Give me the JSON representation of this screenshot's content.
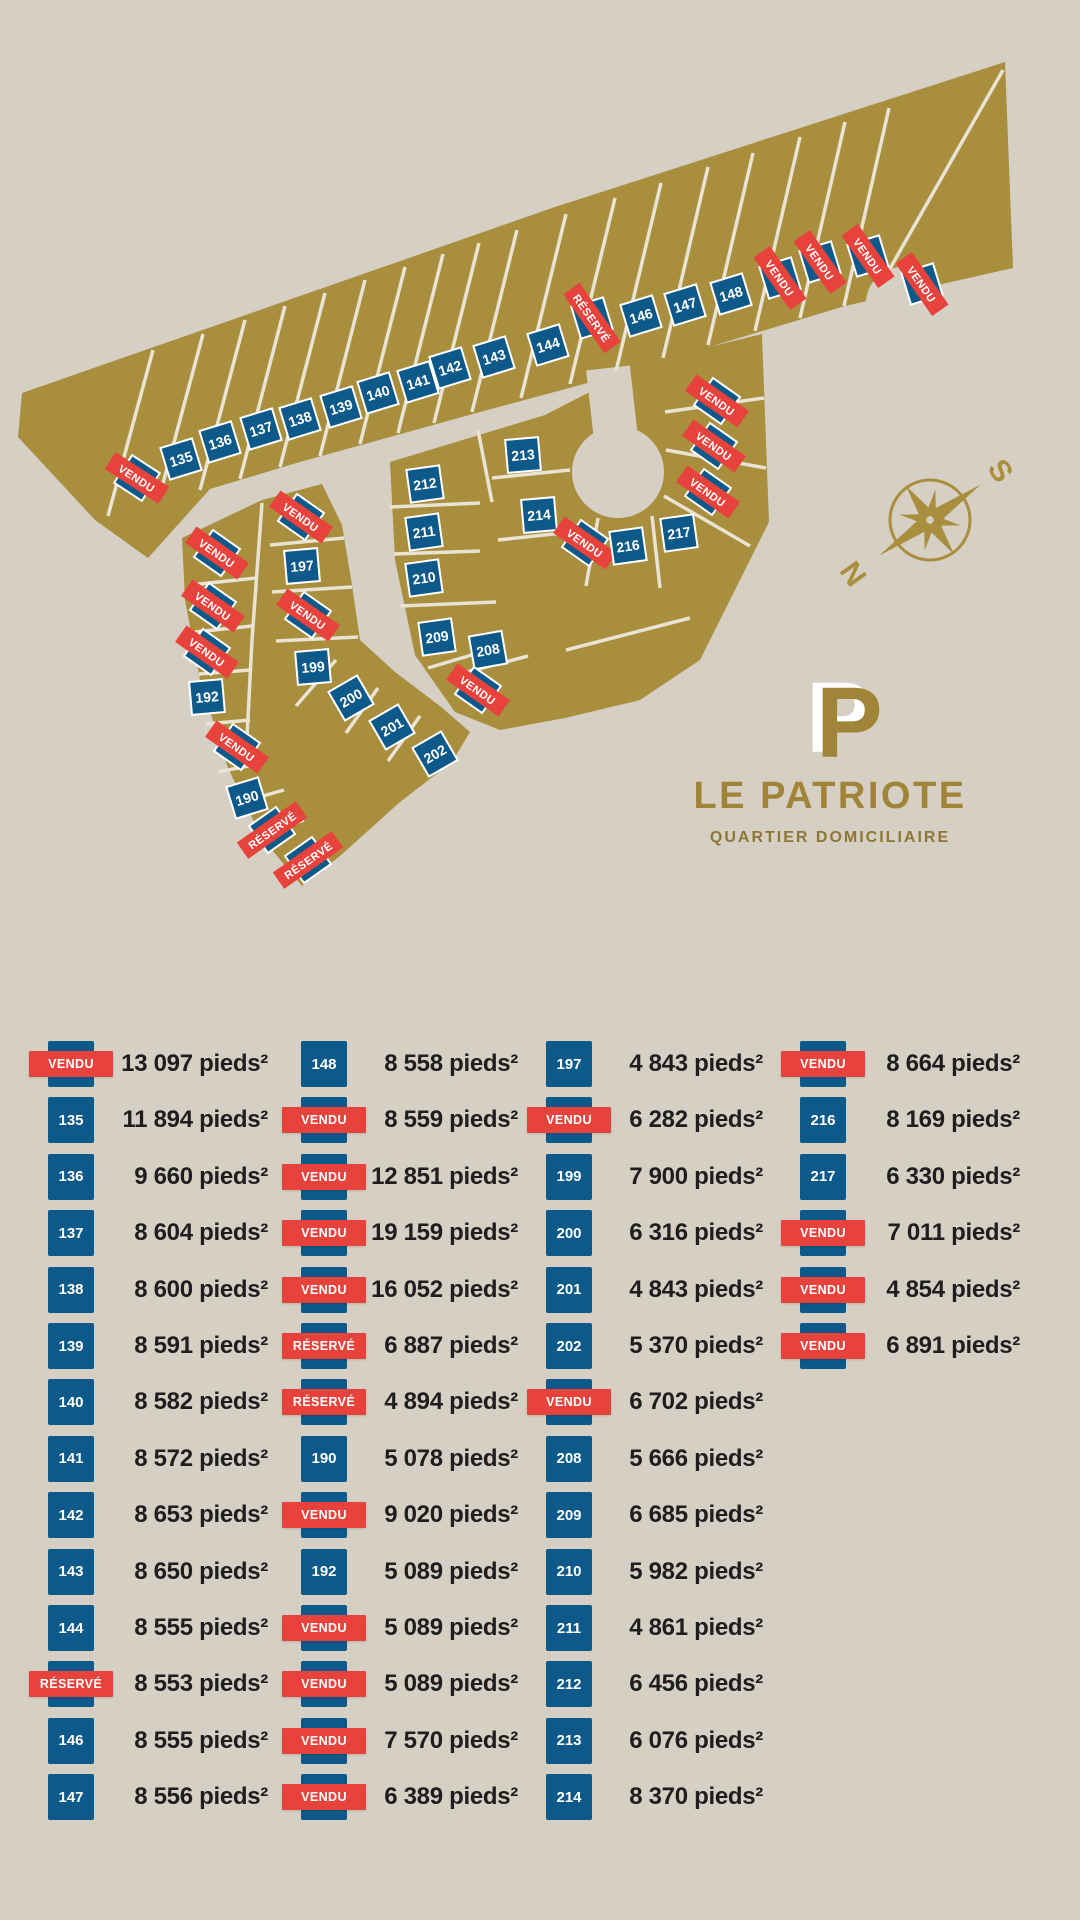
{
  "colors": {
    "background": "#d6d0c4",
    "gold": "#a98e3e",
    "blue": "#0d5a8a",
    "red": "#e8423d",
    "road": "#e9e3d3",
    "text": "#1e1e1e",
    "logo_gold": "#a08539"
  },
  "map": {
    "compass": {
      "north": "N",
      "south": "S"
    },
    "logo": {
      "monogram": "P",
      "title": "LE PATRIOTE",
      "subtitle": "QUARTIER DOMICILIAIRE"
    },
    "lots": [
      {
        "label": "VENDU",
        "type": "vendu",
        "x": 137,
        "y": 478,
        "rot": 33
      },
      {
        "label": "135",
        "type": "num",
        "x": 181,
        "y": 459,
        "rot": -17
      },
      {
        "label": "136",
        "type": "num",
        "x": 220,
        "y": 442,
        "rot": -17
      },
      {
        "label": "137",
        "type": "num",
        "x": 261,
        "y": 429,
        "rot": -17
      },
      {
        "label": "138",
        "type": "num",
        "x": 300,
        "y": 419,
        "rot": -17
      },
      {
        "label": "139",
        "type": "num",
        "x": 341,
        "y": 407,
        "rot": -17
      },
      {
        "label": "140",
        "type": "num",
        "x": 378,
        "y": 393,
        "rot": -17
      },
      {
        "label": "141",
        "type": "num",
        "x": 418,
        "y": 382,
        "rot": -17
      },
      {
        "label": "142",
        "type": "num",
        "x": 450,
        "y": 368,
        "rot": -17
      },
      {
        "label": "143",
        "type": "num",
        "x": 494,
        "y": 357,
        "rot": -17
      },
      {
        "label": "144",
        "type": "num",
        "x": 548,
        "y": 345,
        "rot": -17
      },
      {
        "label": "RÉSERVÉ",
        "type": "reserve",
        "x": 592,
        "y": 318,
        "rot": 55
      },
      {
        "label": "146",
        "type": "num",
        "x": 641,
        "y": 316,
        "rot": -17
      },
      {
        "label": "147",
        "type": "num",
        "x": 685,
        "y": 305,
        "rot": -17
      },
      {
        "label": "148",
        "type": "num",
        "x": 731,
        "y": 294,
        "rot": -17
      },
      {
        "label": "VENDU",
        "type": "vendu",
        "x": 780,
        "y": 278,
        "rot": 55
      },
      {
        "label": "VENDU",
        "type": "vendu",
        "x": 820,
        "y": 262,
        "rot": 55
      },
      {
        "label": "VENDU",
        "type": "vendu",
        "x": 868,
        "y": 256,
        "rot": 55
      },
      {
        "label": "VENDU",
        "type": "vendu",
        "x": 922,
        "y": 284,
        "rot": 55
      },
      {
        "label": "VENDU",
        "type": "vendu",
        "x": 217,
        "y": 553,
        "rot": 35
      },
      {
        "label": "VENDU",
        "type": "vendu",
        "x": 213,
        "y": 606,
        "rot": 35
      },
      {
        "label": "VENDU",
        "type": "vendu",
        "x": 207,
        "y": 652,
        "rot": 35
      },
      {
        "label": "192",
        "type": "num",
        "x": 207,
        "y": 697,
        "rot": -5
      },
      {
        "label": "VENDU",
        "type": "vendu",
        "x": 237,
        "y": 747,
        "rot": 35
      },
      {
        "label": "190",
        "type": "num",
        "x": 247,
        "y": 798,
        "rot": -50
      },
      {
        "label": "RÉSERVÉ",
        "type": "reserve",
        "x": 272,
        "y": 830,
        "rot": -35
      },
      {
        "label": "RÉSERVÉ",
        "type": "reserve",
        "x": 308,
        "y": 860,
        "rot": -35
      },
      {
        "label": "VENDU",
        "type": "vendu",
        "x": 301,
        "y": 517,
        "rot": 35
      },
      {
        "label": "197",
        "type": "num",
        "x": 302,
        "y": 566,
        "rot": -5
      },
      {
        "label": "VENDU",
        "type": "vendu",
        "x": 308,
        "y": 615,
        "rot": 35
      },
      {
        "label": "199",
        "type": "num",
        "x": 313,
        "y": 667,
        "rot": -5
      },
      {
        "label": "200",
        "type": "num",
        "x": 351,
        "y": 698,
        "rot": -30
      },
      {
        "label": "201",
        "type": "num",
        "x": 392,
        "y": 727,
        "rot": -30
      },
      {
        "label": "202",
        "type": "num",
        "x": 435,
        "y": 754,
        "rot": -30
      },
      {
        "label": "212",
        "type": "num",
        "x": 425,
        "y": 484,
        "rot": -8
      },
      {
        "label": "211",
        "type": "num",
        "x": 424,
        "y": 532,
        "rot": -8
      },
      {
        "label": "210",
        "type": "num",
        "x": 424,
        "y": 578,
        "rot": -8
      },
      {
        "label": "209",
        "type": "num",
        "x": 437,
        "y": 637,
        "rot": -8
      },
      {
        "label": "213",
        "type": "num",
        "x": 523,
        "y": 455,
        "rot": -5
      },
      {
        "label": "214",
        "type": "num",
        "x": 539,
        "y": 515,
        "rot": -5
      },
      {
        "label": "208",
        "type": "num",
        "x": 488,
        "y": 650,
        "rot": -10
      },
      {
        "label": "VENDU",
        "type": "vendu",
        "x": 478,
        "y": 690,
        "rot": 35
      },
      {
        "label": "VENDU",
        "type": "vendu",
        "x": 585,
        "y": 543,
        "rot": 35
      },
      {
        "label": "216",
        "type": "num",
        "x": 628,
        "y": 546,
        "rot": -8
      },
      {
        "label": "217",
        "type": "num",
        "x": 679,
        "y": 533,
        "rot": -8
      },
      {
        "label": "VENDU",
        "type": "vendu",
        "x": 708,
        "y": 492,
        "rot": 35
      },
      {
        "label": "VENDU",
        "type": "vendu",
        "x": 714,
        "y": 446,
        "rot": 35
      },
      {
        "label": "VENDU",
        "type": "vendu",
        "x": 717,
        "y": 401,
        "rot": 35
      }
    ]
  },
  "legend": {
    "columns": [
      {
        "rows": [
          {
            "tag": "VENDU",
            "type": "vendu",
            "size": "13 097 pieds²"
          },
          {
            "tag": "135",
            "type": "num",
            "size": "11 894 pieds²"
          },
          {
            "tag": "136",
            "type": "num",
            "size": "9 660 pieds²"
          },
          {
            "tag": "137",
            "type": "num",
            "size": "8 604 pieds²"
          },
          {
            "tag": "138",
            "type": "num",
            "size": "8 600 pieds²"
          },
          {
            "tag": "139",
            "type": "num",
            "size": "8 591 pieds²"
          },
          {
            "tag": "140",
            "type": "num",
            "size": "8 582 pieds²"
          },
          {
            "tag": "141",
            "type": "num",
            "size": "8 572 pieds²"
          },
          {
            "tag": "142",
            "type": "num",
            "size": "8 653 pieds²"
          },
          {
            "tag": "143",
            "type": "num",
            "size": "8 650 pieds²"
          },
          {
            "tag": "144",
            "type": "num",
            "size": "8 555 pieds²"
          },
          {
            "tag": "RÉSERVÉ",
            "type": "reserve",
            "size": "8 553 pieds²"
          },
          {
            "tag": "146",
            "type": "num",
            "size": "8 555 pieds²"
          },
          {
            "tag": "147",
            "type": "num",
            "size": "8 556 pieds²"
          }
        ]
      },
      {
        "rows": [
          {
            "tag": "148",
            "type": "num",
            "size": "8 558 pieds²"
          },
          {
            "tag": "VENDU",
            "type": "vendu",
            "size": "8 559 pieds²"
          },
          {
            "tag": "VENDU",
            "type": "vendu",
            "size": "12 851 pieds²"
          },
          {
            "tag": "VENDU",
            "type": "vendu",
            "size": "19 159 pieds²"
          },
          {
            "tag": "VENDU",
            "type": "vendu",
            "size": "16 052 pieds²"
          },
          {
            "tag": "RÉSERVÉ",
            "type": "reserve",
            "size": "6 887 pieds²"
          },
          {
            "tag": "RÉSERVÉ",
            "type": "reserve",
            "size": "4 894 pieds²"
          },
          {
            "tag": "190",
            "type": "num",
            "size": "5 078 pieds²"
          },
          {
            "tag": "VENDU",
            "type": "vendu",
            "size": "9 020 pieds²"
          },
          {
            "tag": "192",
            "type": "num",
            "size": "5 089 pieds²"
          },
          {
            "tag": "VENDU",
            "type": "vendu",
            "size": "5 089 pieds²"
          },
          {
            "tag": "VENDU",
            "type": "vendu",
            "size": "5 089 pieds²"
          },
          {
            "tag": "VENDU",
            "type": "vendu",
            "size": "7 570 pieds²"
          },
          {
            "tag": "VENDU",
            "type": "vendu",
            "size": "6 389 pieds²"
          }
        ]
      },
      {
        "rows": [
          {
            "tag": "197",
            "type": "num",
            "size": "4 843 pieds²"
          },
          {
            "tag": "VENDU",
            "type": "vendu",
            "size": "6 282 pieds²"
          },
          {
            "tag": "199",
            "type": "num",
            "size": "7 900 pieds²"
          },
          {
            "tag": "200",
            "type": "num",
            "size": "6 316 pieds²"
          },
          {
            "tag": "201",
            "type": "num",
            "size": "4 843 pieds²"
          },
          {
            "tag": "202",
            "type": "num",
            "size": "5 370 pieds²"
          },
          {
            "tag": "VENDU",
            "type": "vendu",
            "size": "6 702 pieds²"
          },
          {
            "tag": "208",
            "type": "num",
            "size": "5 666 pieds²"
          },
          {
            "tag": "209",
            "type": "num",
            "size": "6 685 pieds²"
          },
          {
            "tag": "210",
            "type": "num",
            "size": "5 982 pieds²"
          },
          {
            "tag": "211",
            "type": "num",
            "size": "4 861 pieds²"
          },
          {
            "tag": "212",
            "type": "num",
            "size": "6 456 pieds²"
          },
          {
            "tag": "213",
            "type": "num",
            "size": "6 076 pieds²"
          },
          {
            "tag": "214",
            "type": "num",
            "size": "8 370 pieds²"
          }
        ]
      },
      {
        "rows": [
          {
            "tag": "VENDU",
            "type": "vendu",
            "size": "8 664 pieds²"
          },
          {
            "tag": "216",
            "type": "num",
            "size": "8 169 pieds²"
          },
          {
            "tag": "217",
            "type": "num",
            "size": "6 330 pieds²"
          },
          {
            "tag": "VENDU",
            "type": "vendu",
            "size": "7 011 pieds²"
          },
          {
            "tag": "VENDU",
            "type": "vendu",
            "size": "4 854 pieds²"
          },
          {
            "tag": "VENDU",
            "type": "vendu",
            "size": "6 891 pieds²"
          }
        ]
      }
    ]
  }
}
